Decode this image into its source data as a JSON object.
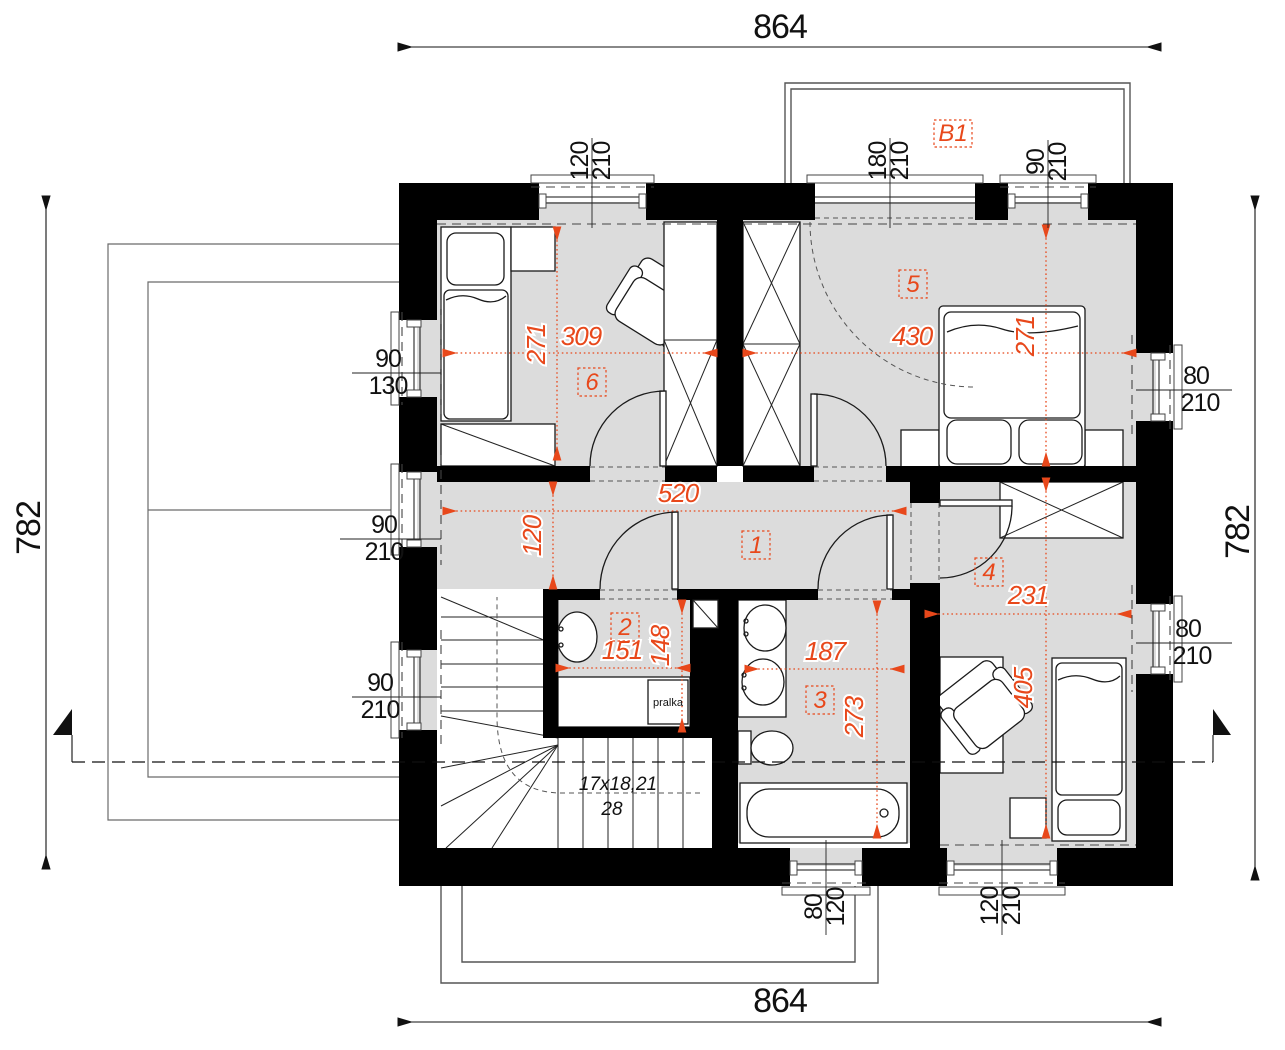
{
  "meta": {
    "drawing": "first-floor-plan"
  },
  "overall_dims": {
    "top": "864",
    "bottom": "864",
    "left": "782",
    "right": "782"
  },
  "rooms": {
    "r1": "1",
    "r2": "2",
    "r3": "3",
    "r4": "4",
    "r5": "5",
    "r6": "6",
    "balcony": "B1"
  },
  "dims": {
    "room6_width": "309",
    "room6_depth": "271",
    "room5_width": "430",
    "room5_depth": "271",
    "hall_length": "520",
    "hall_width": "120",
    "wc_width": "151",
    "wc_depth": "148",
    "bath_width": "187",
    "bath_depth": "273",
    "room4_width": "231",
    "room4_depth": "405"
  },
  "windows": {
    "top1": {
      "w": "120",
      "h": "210"
    },
    "top2": {
      "w": "180",
      "h": "210"
    },
    "top3": {
      "w": "90",
      "h": "210"
    },
    "left1": {
      "w": "90",
      "h": "130"
    },
    "left2": {
      "w": "90",
      "h": "210"
    },
    "left3": {
      "w": "90",
      "h": "210"
    },
    "right1": {
      "w": "80",
      "h": "210"
    },
    "right2": {
      "w": "80",
      "h": "210"
    },
    "bottom1": {
      "w": "80",
      "h": "120"
    },
    "bottom2": {
      "w": "120",
      "h": "210"
    }
  },
  "stairs": {
    "run": "17x18,21",
    "steps": "28"
  },
  "appliances": {
    "washer": "pralka"
  },
  "colors": {
    "accent": "#e8481b",
    "floor": "#dcdcdc",
    "wall": "#000000"
  }
}
